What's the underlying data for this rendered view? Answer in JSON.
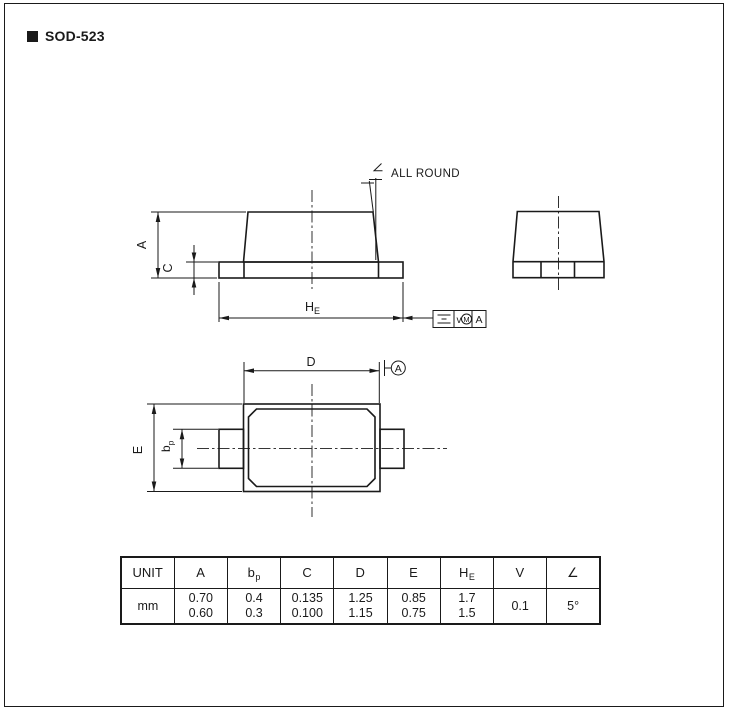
{
  "page": {
    "title": "SOD-523"
  },
  "drawing": {
    "annotations": {
      "all_round": "ALL ROUND",
      "datum": "A"
    },
    "labels": {
      "dim_a": "A",
      "dim_c": "C",
      "dim_he": {
        "main": "H",
        "sub": "E"
      },
      "dim_d": "D",
      "dim_e": "E",
      "dim_bp": {
        "main": "b",
        "sub": "p"
      }
    },
    "fcf": {
      "symbol": "symmetry",
      "tolerance": "v",
      "modifier": "M",
      "datum": "A"
    }
  },
  "table": {
    "headers": [
      {
        "main": "UNIT",
        "sub": ""
      },
      {
        "main": "A",
        "sub": ""
      },
      {
        "main": "b",
        "sub": "p"
      },
      {
        "main": "C",
        "sub": ""
      },
      {
        "main": "D",
        "sub": ""
      },
      {
        "main": "E",
        "sub": ""
      },
      {
        "main": "H",
        "sub": "E"
      },
      {
        "main": "V",
        "sub": ""
      },
      {
        "main": "∠",
        "sub": ""
      }
    ],
    "rows": [
      {
        "unit": "mm",
        "values": [
          {
            "line1": "0.70",
            "line2": "0.60"
          },
          {
            "line1": "0.4",
            "line2": "0.3"
          },
          {
            "line1": "0.135",
            "line2": "0.100"
          },
          {
            "line1": "1.25",
            "line2": "1.15"
          },
          {
            "line1": "0.85",
            "line2": "0.75"
          },
          {
            "line1": "1.7",
            "line2": "1.5"
          },
          {
            "line1": "0.1",
            "line2": ""
          },
          {
            "line1": "5°",
            "line2": ""
          }
        ]
      }
    ]
  },
  "colors": {
    "line": "#1a1a1a",
    "background": "#ffffff"
  }
}
